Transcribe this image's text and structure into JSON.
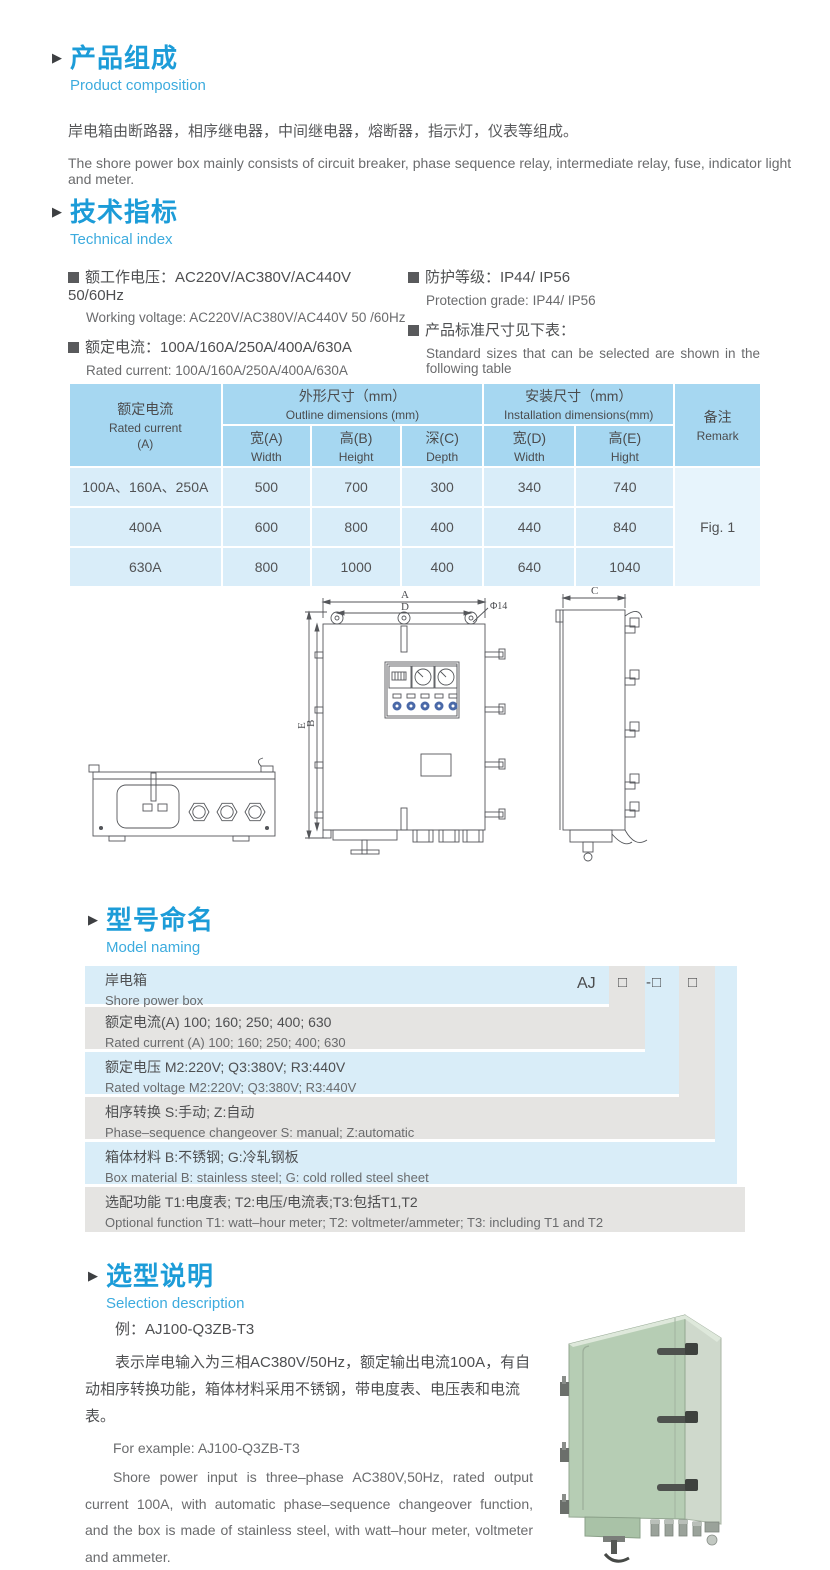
{
  "colors": {
    "accent_heading": "#1C9CD8",
    "accent_subtitle": "#3CABDE",
    "body_text": "#58595B",
    "secondary_text": "#6A6B6D",
    "table_header_bg": "#A6D7F1",
    "table_row_bg": "#D9EDF9",
    "table_remark_bg": "#E7F4FC",
    "model_row_blue": "#D9EDF8",
    "model_row_gray": "#E5E4E2",
    "indicator_blue": "#4A69A8",
    "box_green": "#B6CDB4"
  },
  "composition": {
    "title_cn": "产品组成",
    "title_en": "Product  composition",
    "body_cn": "岸电箱由断路器，相序继电器，中间继电器，熔断器，指示灯，仪表等组成。",
    "body_en": "The shore power box mainly consists of circuit breaker, phase sequence relay, intermediate relay, fuse, indicator light and meter."
  },
  "technical": {
    "title_cn": "技术指标",
    "title_en": "Technical index",
    "specs": [
      {
        "cn": "额工作电压：AC220V/AC380V/AC440V  50/60Hz",
        "en": "Working voltage: AC220V/AC380V/AC440V 50 /60Hz"
      },
      {
        "cn": "额定电流：100A/160A/250A/400A/630A",
        "en": "Rated current: 100A/160A/250A/400A/630A"
      },
      {
        "cn": "防护等级：IP44/ IP56",
        "en": "Protection grade: IP44/ IP56"
      },
      {
        "cn": "产品标准尺寸见下表：",
        "en": "Standard sizes that can be selected are shown in the following table"
      }
    ]
  },
  "dims": {
    "col_current_cn": "额定电流",
    "col_current_en": "Rated current",
    "col_current_unit": "(A)",
    "col_outline_cn": "外形尺寸（mm）",
    "col_outline_en": "Outline dimensions (mm)",
    "col_install_cn": "安装尺寸（mm）",
    "col_install_en": "Installation dimensions(mm)",
    "col_remark_cn": "备注",
    "col_remark_en": "Remark",
    "sub": [
      {
        "cn": "宽(A)",
        "en": "Width"
      },
      {
        "cn": "高(B)",
        "en": "Height"
      },
      {
        "cn": "深(C)",
        "en": "Depth"
      },
      {
        "cn": "宽(D)",
        "en": "Width"
      },
      {
        "cn": "高(E)",
        "en": "Hight"
      }
    ],
    "rows": [
      {
        "label": "100A、160A、250A",
        "w": "500",
        "h": "700",
        "d": "300",
        "iw": "340",
        "ih": "740"
      },
      {
        "label": "400A",
        "w": "600",
        "h": "800",
        "d": "400",
        "iw": "440",
        "ih": "840"
      },
      {
        "label": "630A",
        "w": "800",
        "h": "1000",
        "d": "400",
        "iw": "640",
        "ih": "1040"
      }
    ],
    "remark": "Fig. 1"
  },
  "drawing": {
    "dim_a": "A",
    "dim_b": "B",
    "dim_c": "C",
    "dim_d": "D",
    "dim_e": "E",
    "hole": "Φ14"
  },
  "model": {
    "title_cn": "型号命名",
    "title_en": "Model naming",
    "product_cn": "岸电箱",
    "product_en": "Shore power box",
    "prefix": "AJ",
    "box1": "□",
    "box2": "-□",
    "box3": "□",
    "rows": [
      {
        "cn": "额定电流(A)  100; 160; 250; 400; 630",
        "en": "Rated current (A) 100; 160; 250; 400; 630"
      },
      {
        "cn": "额定电压   M2:220V;  Q3:380V;  R3:440V",
        "en": "Rated voltage  M2:220V;  Q3:380V;  R3:440V"
      },
      {
        "cn": "相序转换  S:手动; Z:自动",
        "en": "Phase–sequence changeover  S: manual;  Z:automatic"
      },
      {
        "cn": "箱体材料    B:不锈钢;  G:冷轧钢板",
        "en": "Box material    B: stainless steel; G: cold rolled steel sheet"
      },
      {
        "cn": "选配功能     T1:电度表;  T2:电压/电流表;T3:包括T1,T2",
        "en": "Optional function  T1: watt–hour meter; T2: voltmeter/ammeter; T3: including T1 and T2"
      }
    ]
  },
  "selection": {
    "title_cn": "选型说明",
    "title_en": "Selection description",
    "example_cn": "例：AJ100-Q3ZB-T3",
    "para_cn": "表示岸电输入为三相AC380V/50Hz，额定输出电流100A，有自动相序转换功能，箱体材料采用不锈钢，带电度表、电压表和电流表。",
    "example_en": "For example: AJ100-Q3ZB-T3",
    "para_en": "Shore power input is three–phase AC380V,50Hz, rated output current 100A, with automatic phase–sequence changeover function, and the box is made of stainless steel, with watt–hour meter, voltmeter and ammeter."
  }
}
